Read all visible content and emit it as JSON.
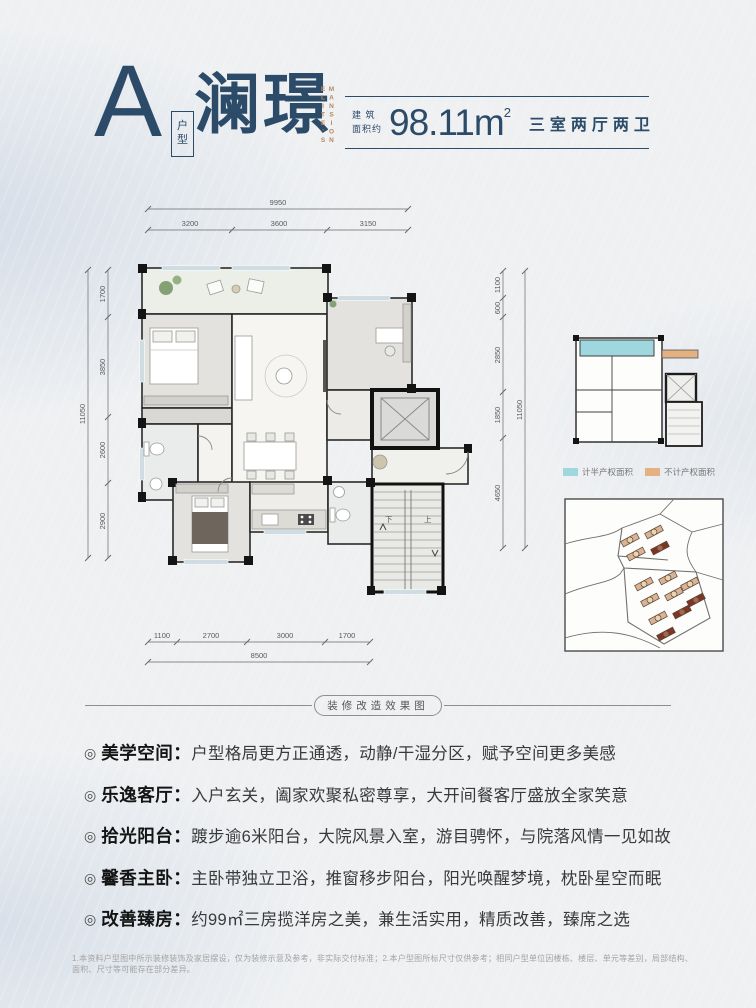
{
  "meta": {
    "bullet": "◎",
    "colon": "："
  },
  "header": {
    "unit_letter": "A",
    "unit_type_char1": "户",
    "unit_type_char2": "型",
    "unit_name": "澜璟",
    "unit_name_en_col1": "ELITE'S",
    "unit_name_en_col2": "MANSION",
    "area_label_line1": "建 筑",
    "area_label_line2": "面积约",
    "area_value": "98.11m",
    "area_exponent": "2",
    "rooms_desc": "三室两厅两卫"
  },
  "floorplan": {
    "dims_top": {
      "overall": "9950",
      "segments": [
        "3200",
        "3600",
        "3150"
      ]
    },
    "dims_left": {
      "overall": "11050",
      "segments": [
        "1700",
        "3850",
        "2600",
        "2900"
      ]
    },
    "dims_right": {
      "overall": "11050",
      "segments": [
        "1100",
        "600",
        "2850",
        "1850",
        "4650"
      ]
    },
    "dims_bottom": {
      "overall": "8500",
      "segments": [
        "1100",
        "2700",
        "3000",
        "1700"
      ]
    },
    "stair_down": "下",
    "stair_up": "上"
  },
  "keyplan": {
    "legend": [
      {
        "label": "计半产权面积",
        "color": "#9ed7dd"
      },
      {
        "label": "不计产权面积",
        "color": "#e4b183"
      }
    ]
  },
  "divider": {
    "label": "装修改造效果图"
  },
  "features": [
    {
      "title": "美学空间",
      "desc": "户型格局更方正通透，动静/干湿分区，赋予空间更多美感"
    },
    {
      "title": "乐逸客厅",
      "desc": "入户玄关，阖家欢聚私密尊享，大开间餐客厅盛放全家笑意"
    },
    {
      "title": "拾光阳台",
      "desc": "踱步逾6米阳台，大院风景入室，游目骋怀，与院落风情一见如故"
    },
    {
      "title": "馨香主卧",
      "desc": "主卧带独立卫浴，推窗移步阳台，阳光唤醒梦境，枕卧星空而眠"
    },
    {
      "title": "改善臻房",
      "desc": "约99㎡三房揽洋房之美，兼生活实用，精质改善，臻席之选"
    }
  ],
  "footer": {
    "disclaimer": "1.本资料户型图中所示装修装饰及家居摆设，仅为装修示意及参考，非实际交付标准；2.本户型图所标尺寸仅供参考；相同户型单位因楼栋、楼层、单元等差别，局部结构、面积、尺寸等可能存在部分差异。"
  },
  "colors": {
    "navy": "#2c4b68",
    "tan": "#b9885c",
    "half_area": "#9ed7dd",
    "excluded_area": "#e4b183"
  }
}
